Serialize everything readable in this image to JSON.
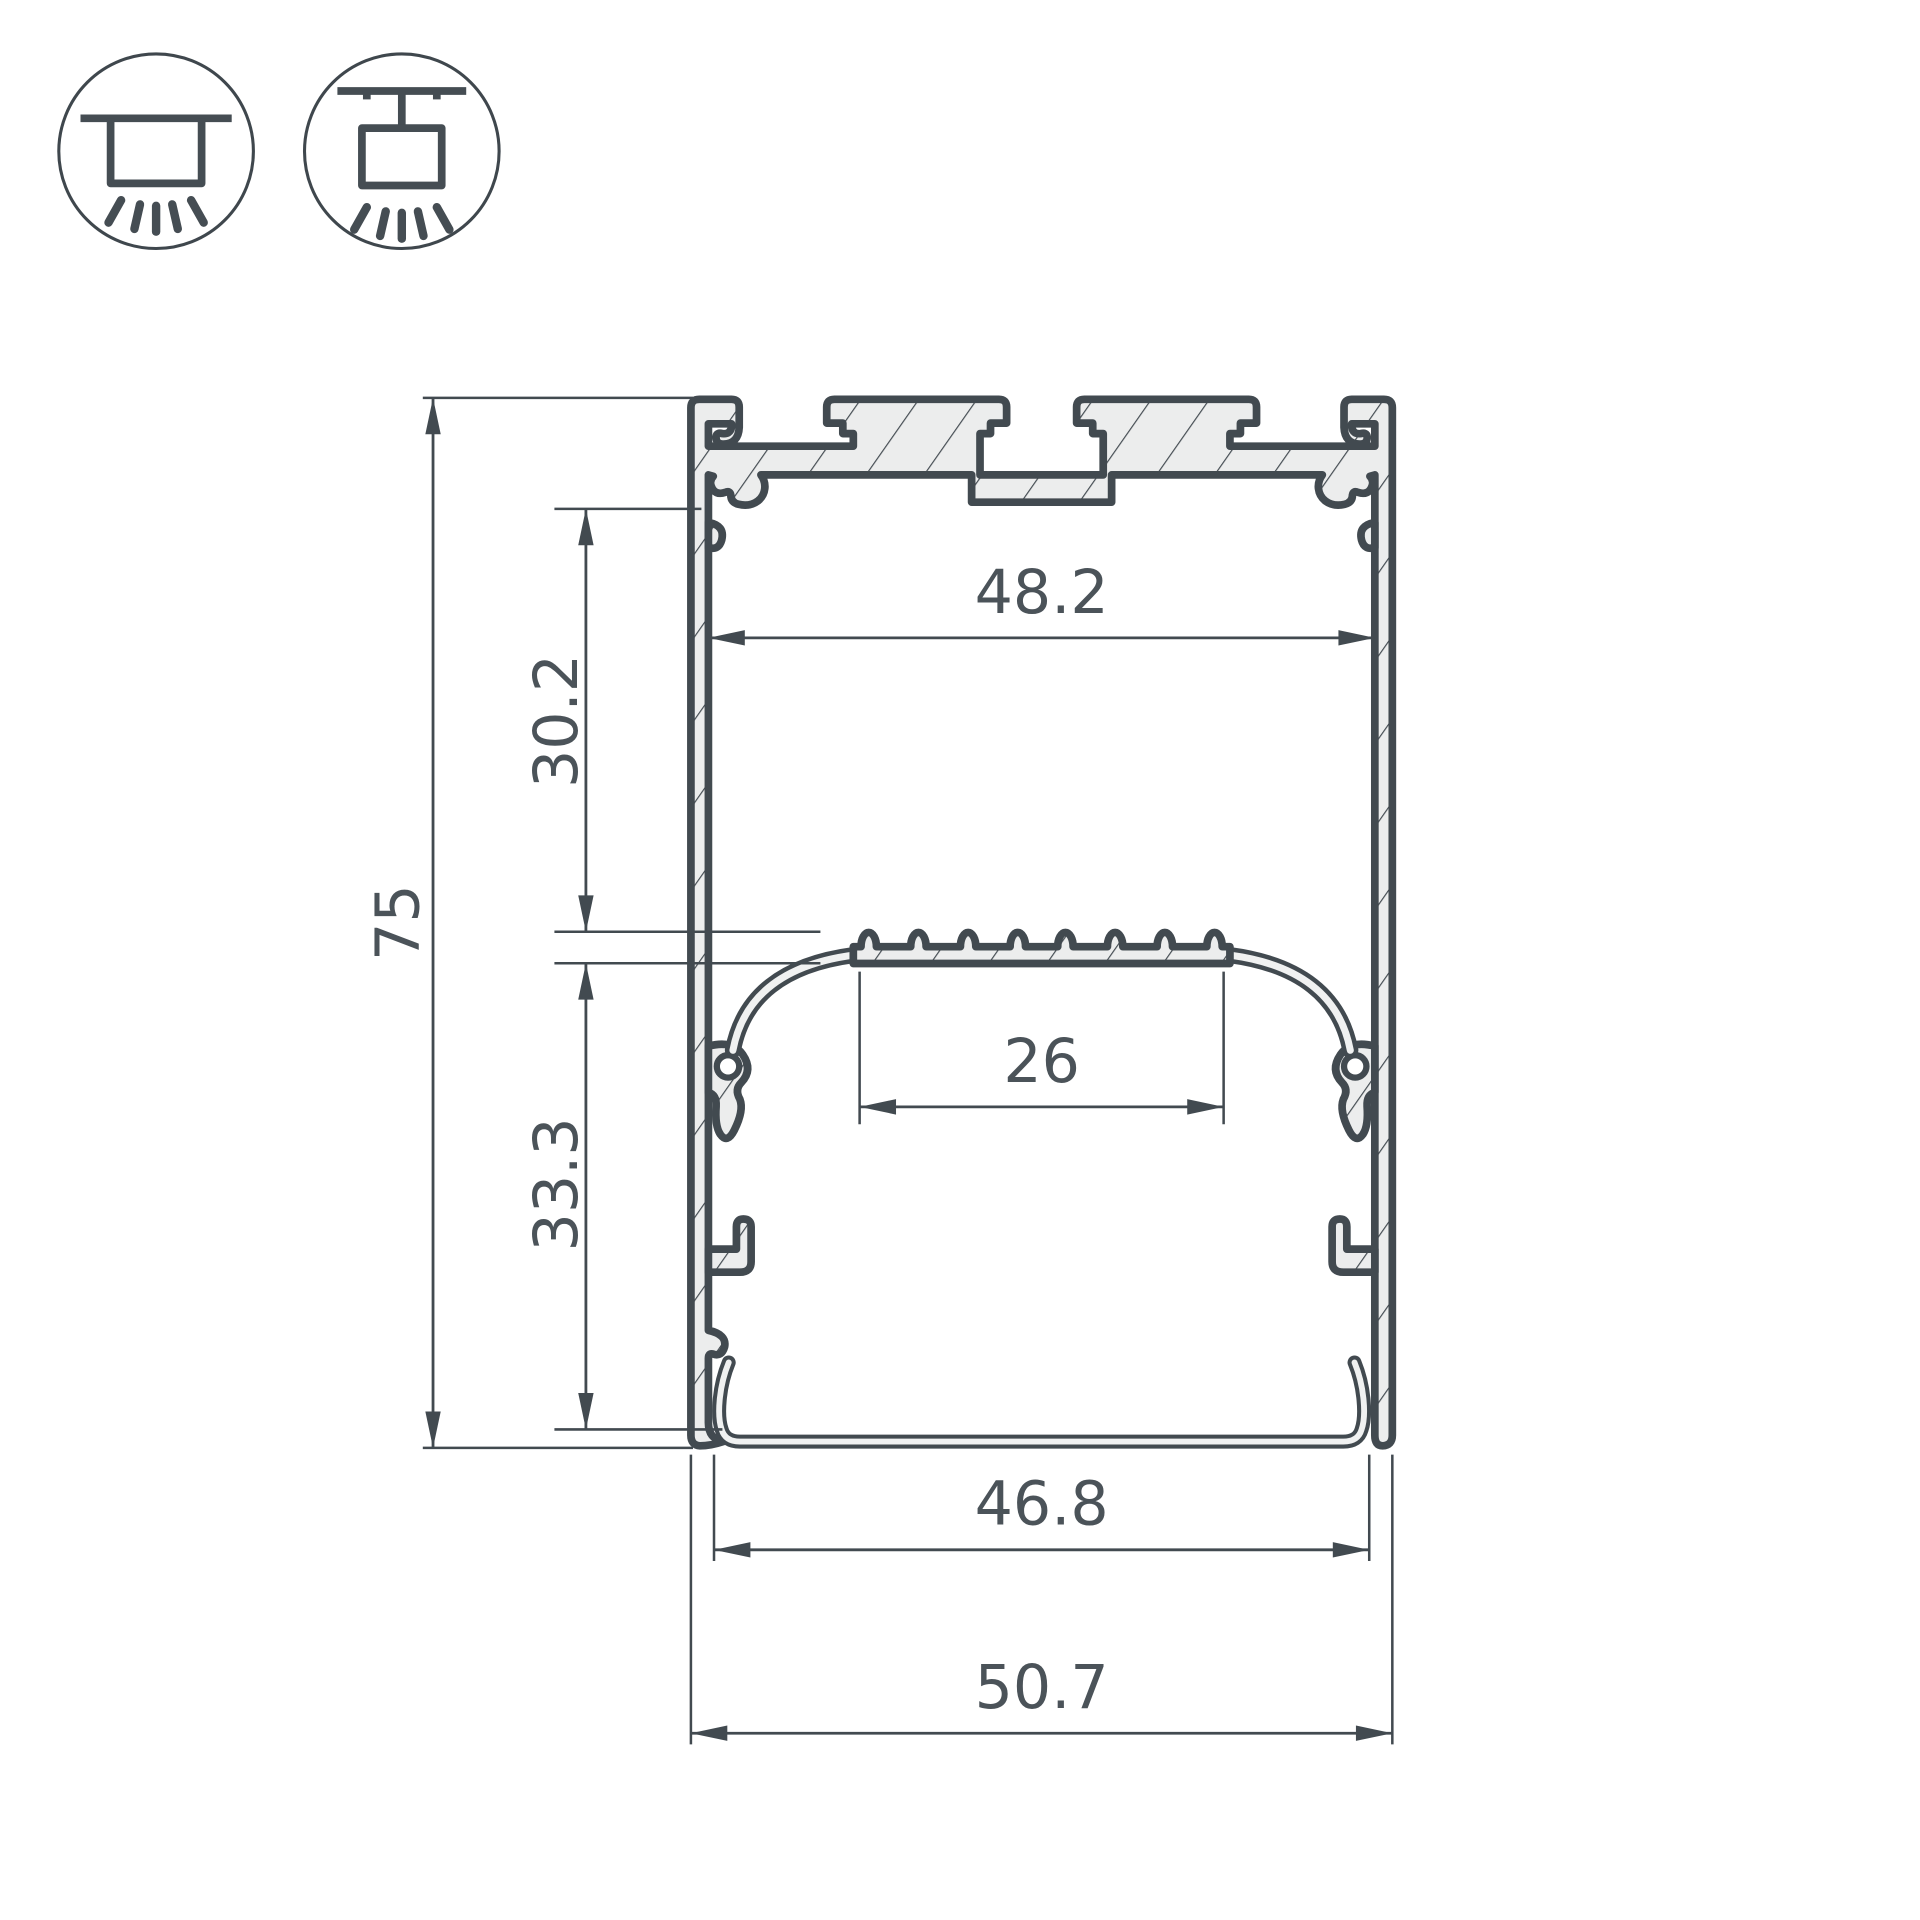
{
  "colors": {
    "background": "#ffffff",
    "line": "#424a50",
    "metal_fill": "#eceded",
    "text": "#4b5359"
  },
  "icons": {
    "surface": {
      "name": "surface-mount-icon",
      "meaning": "surface ceiling mounted luminaire"
    },
    "pendant": {
      "name": "pendant-mount-icon",
      "meaning": "suspended (pendant) luminaire"
    }
  },
  "drawing": {
    "type": "led-profile-cross-section",
    "dims": {
      "inner_top_width": "48.2",
      "upper_chamber_height": "30.2",
      "total_height": "75",
      "led_shelf_width": "26",
      "lower_chamber_height": "33.3",
      "bottom_opening_width": "46.8",
      "overall_width": "50.7"
    },
    "dims_mm": {
      "inner_top_width": 48.2,
      "upper_chamber_height": 30.2,
      "total_height": 75,
      "led_shelf_width": 26,
      "lower_chamber_height": 33.3,
      "bottom_opening_width": 46.8,
      "overall_width": 50.7
    }
  }
}
